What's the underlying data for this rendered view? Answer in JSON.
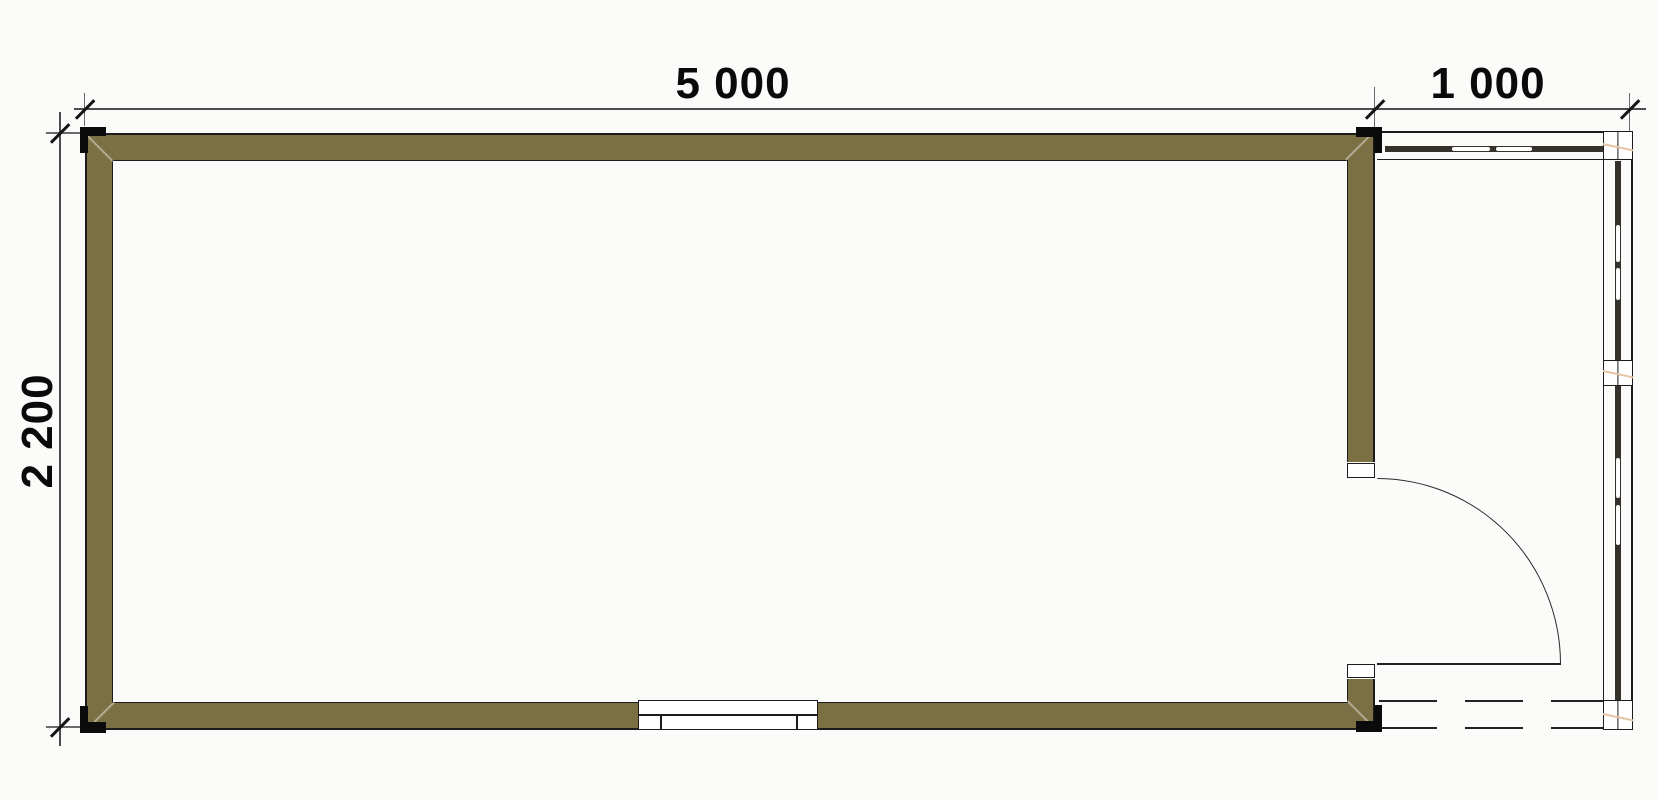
{
  "dimensions": {
    "overall_width_label": "5 000",
    "porch_width_label": "1 000",
    "overall_depth_label": "2 200"
  },
  "colors": {
    "wall_fill": "#7b6f44",
    "outline": "#1c1c1c",
    "dimension_line": "#4d4d4d",
    "glazing": "#35322c",
    "mullion_accent": "#e4c4a3",
    "background": "#fbfbfa",
    "text": "#0a0a0a"
  }
}
